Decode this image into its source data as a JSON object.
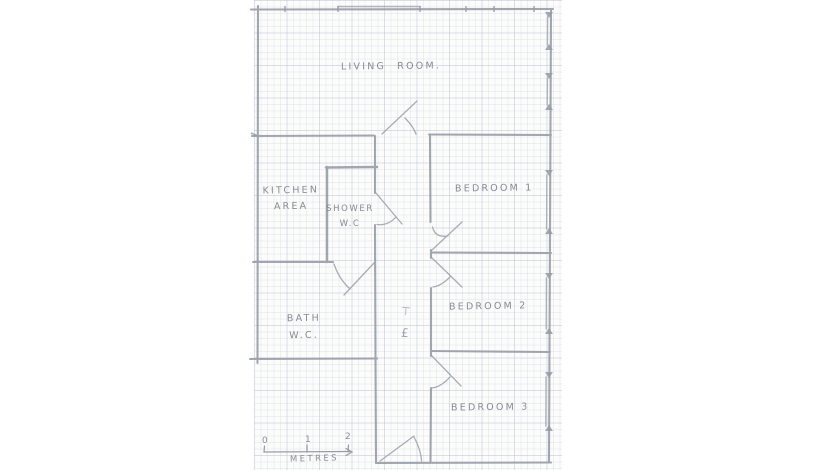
{
  "rooms": {
    "living": "LIVING  ROOM.",
    "kitchen1": "KITCHEN",
    "kitchen2": "AREA",
    "shower1": "SHOWER",
    "shower2": "W.C",
    "bath1": "BATH",
    "bath2": "W.C.",
    "bed1": "BEDROOM 1",
    "bed2": "BEDROOM 2",
    "bed3": "BEDROOM 3"
  },
  "scale_bar": {
    "t0": "0",
    "t1": "1",
    "t2": "2",
    "unit": "METRES"
  },
  "hall_marks": {
    "glyph1": "⊤",
    "glyph2": "£"
  },
  "colors": {
    "pencil": "#959ba5",
    "text": "#7d828c",
    "paper": "#fcfcfb",
    "grid": "#bcc6d8"
  }
}
